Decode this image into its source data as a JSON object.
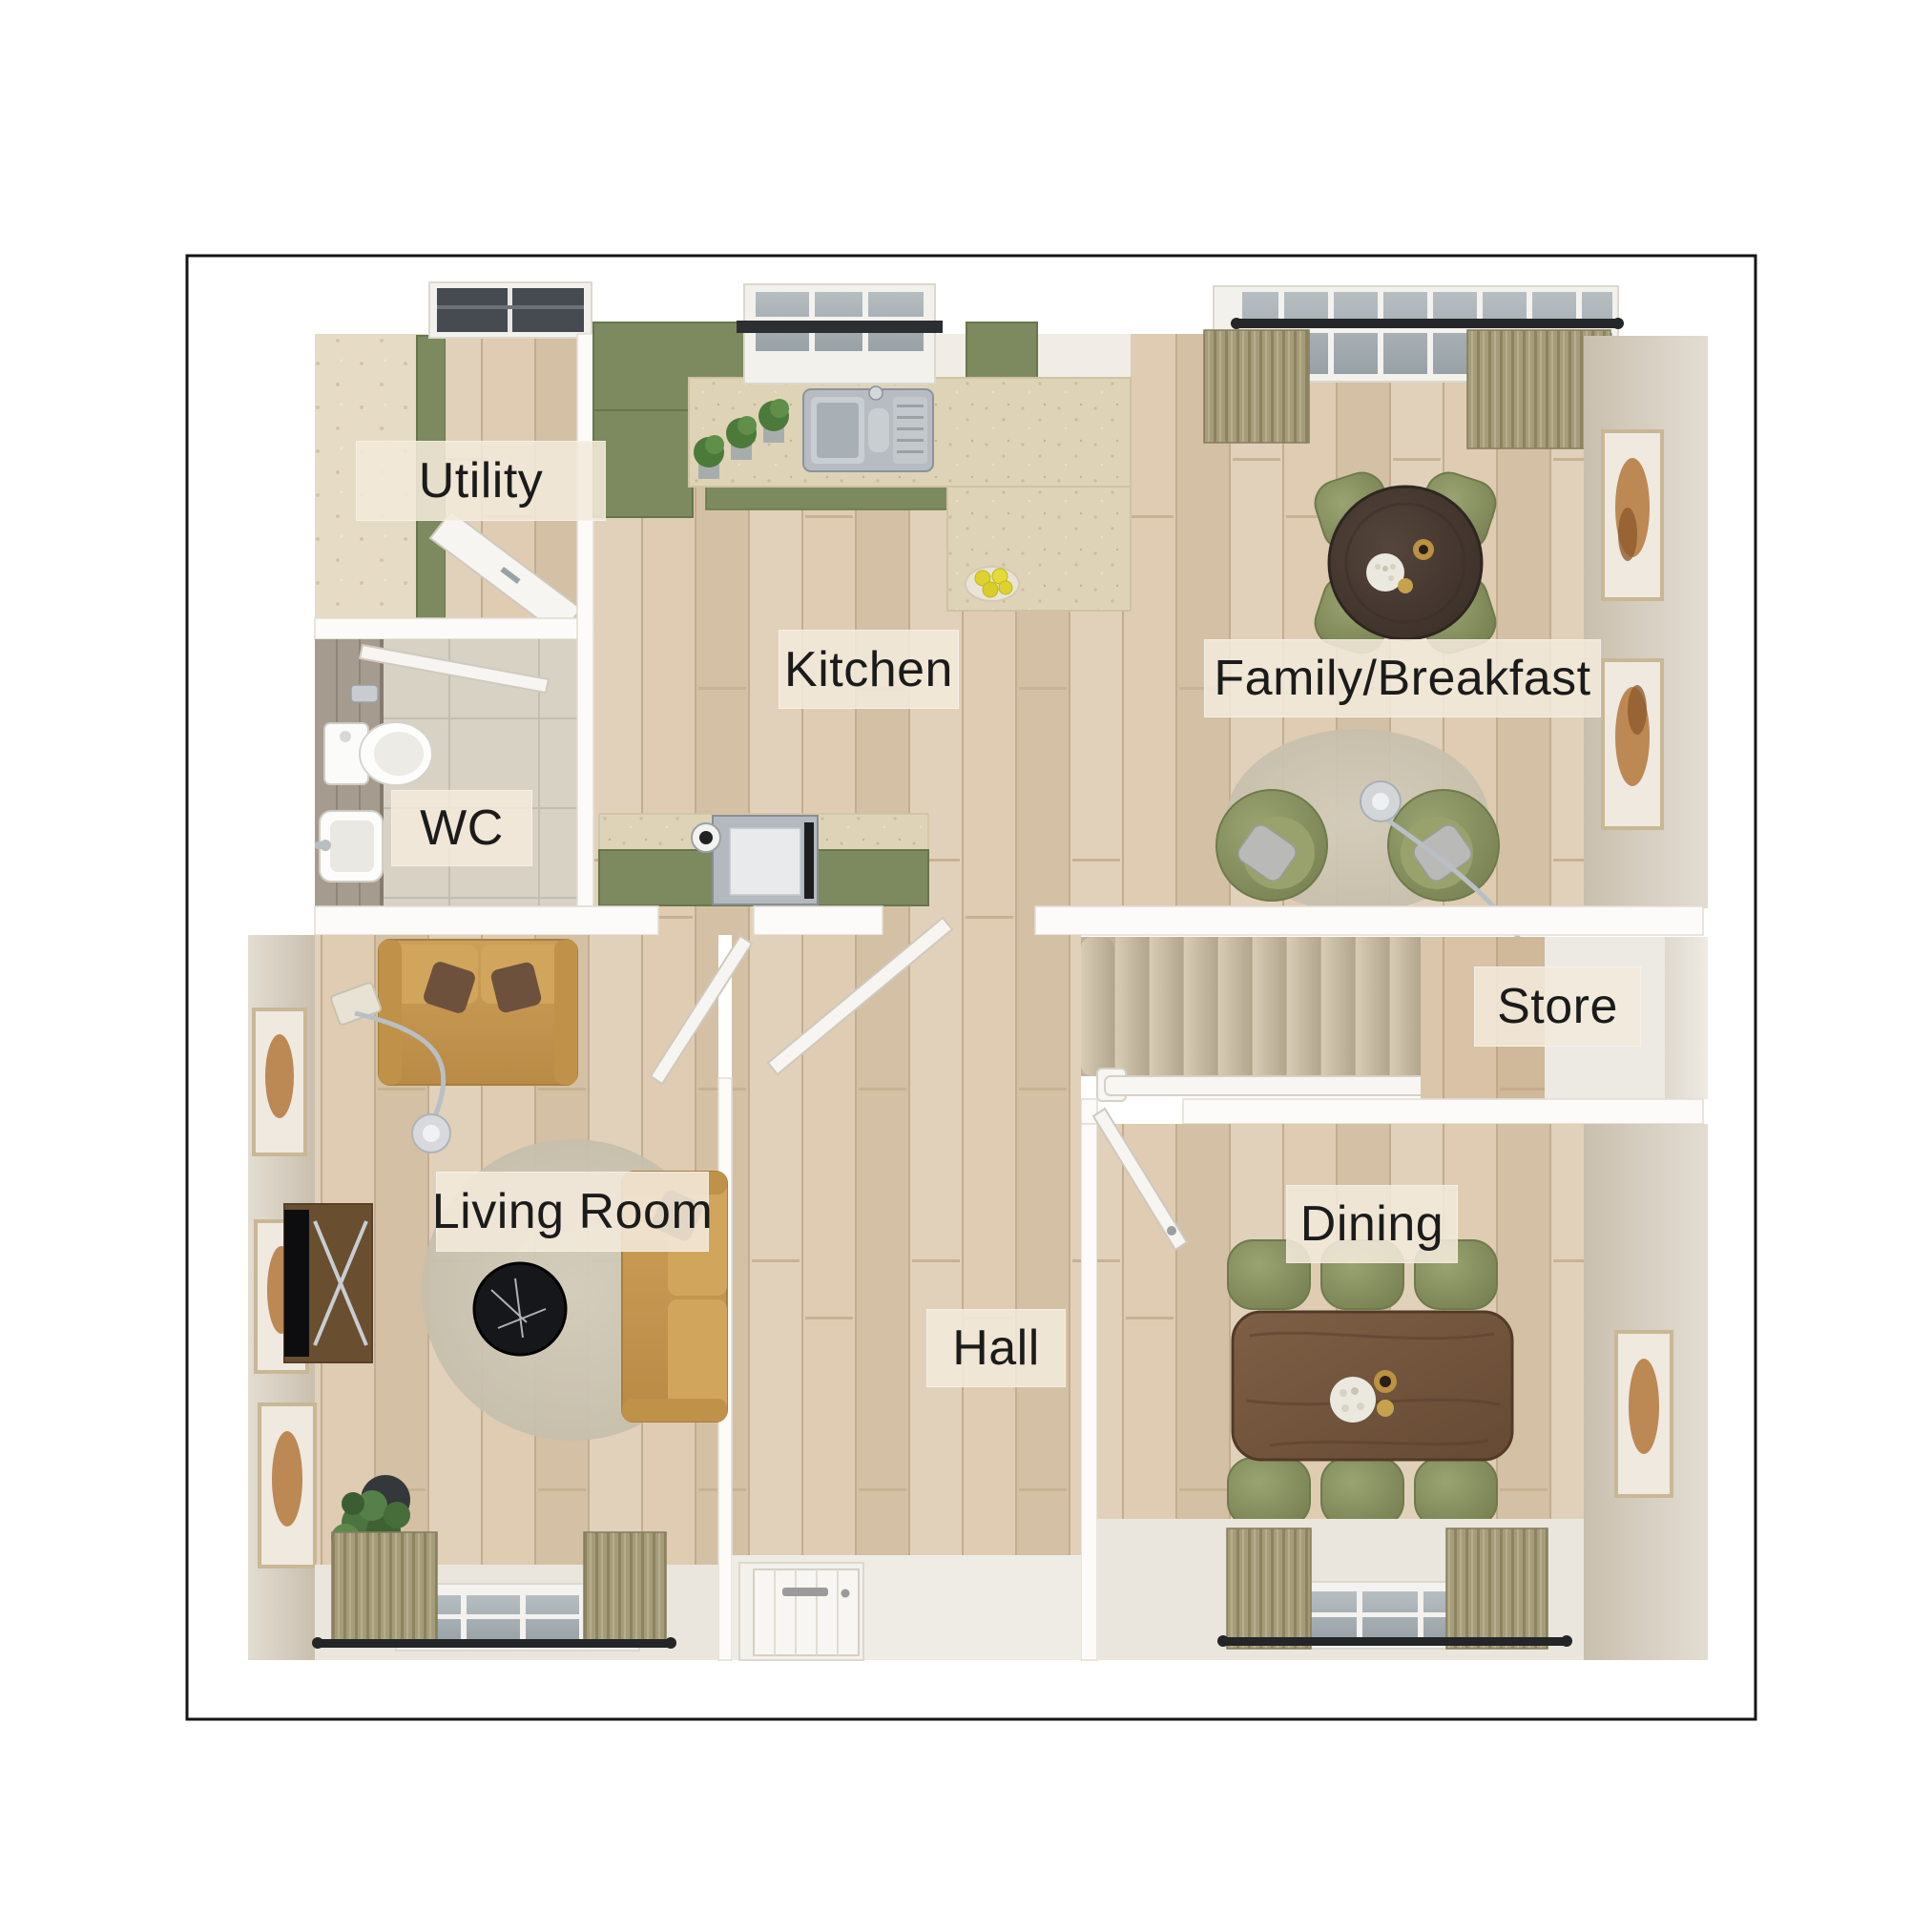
{
  "floorplan": {
    "title": "Ground floor plan",
    "rooms": [
      {
        "id": "utility",
        "label": "Utility"
      },
      {
        "id": "wc",
        "label": "WC"
      },
      {
        "id": "kitchen",
        "label": "Kitchen"
      },
      {
        "id": "family-breakfast",
        "label": "Family/Breakfast"
      },
      {
        "id": "store",
        "label": "Store"
      },
      {
        "id": "living-room",
        "label": "Living Room"
      },
      {
        "id": "hall",
        "label": "Hall"
      },
      {
        "id": "dining",
        "label": "Dining"
      }
    ],
    "colors": {
      "page_background": "#ffffff",
      "border_line": "#141414",
      "wall_white": "#fcfbf9",
      "wood_floor": "#d9c6ad",
      "utility_tile": "#e6dcc6",
      "wc_tile": "#d8d2c5",
      "cabinet_green": "#7d8a5f",
      "counter_beige": "#ded3b7",
      "sofa_mustard": "#c79a52",
      "chair_olive": "#87905e",
      "dining_table_wood": "#74543c",
      "family_table_wood": "#463832",
      "stairs_carpet": "#c9bda6",
      "curtain_olive": "#a39a79",
      "label_background": "#f2e9db",
      "label_text": "#1b1b1b"
    }
  }
}
